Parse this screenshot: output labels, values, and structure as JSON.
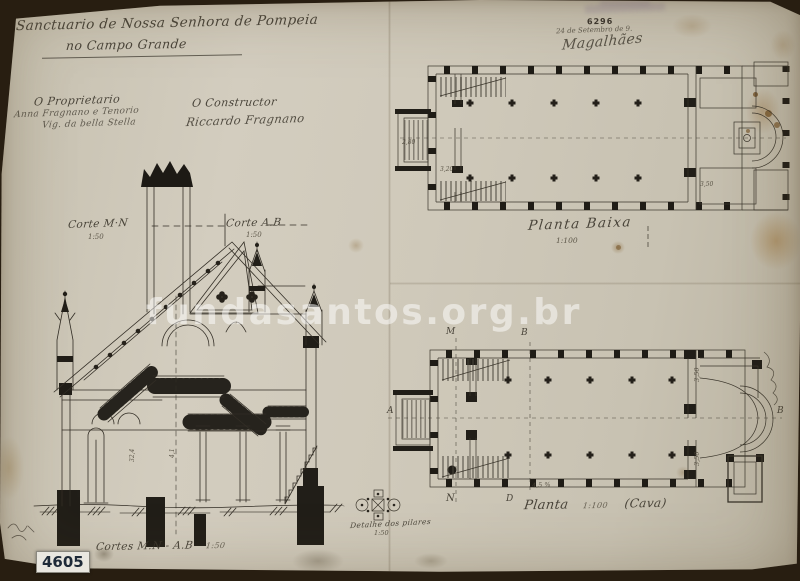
{
  "photo": {
    "archive_number": "4605",
    "watermark": "fundasantos.org.br"
  },
  "title": {
    "line1": "Sanctuario de Nossa Senhora de Pompeia",
    "line2": "no Campo Grande"
  },
  "stamp": {
    "number": "6296",
    "date": "24 de Setembro de 9.",
    "signature": "Magalhães"
  },
  "parties": {
    "proprietor_label": "O Proprietario",
    "proprietor_sig1": "Anna Fragnano e Tenorio",
    "proprietor_sig2": "Vig. da bella Stella",
    "constructor_label": "O Constructor",
    "constructor_sig": "Riccardo Fragnano"
  },
  "section": {
    "corte_left": "Corte M·N",
    "corte_left_scale": "1:50",
    "corte_right": "Corte A.B",
    "corte_right_scale": "1:50",
    "caption": "Cortes M.N - A.B",
    "caption_scale": "1:50",
    "dim_a": "32,4",
    "dim_b": "4,1"
  },
  "plan_upper": {
    "caption": "Planta Baixa",
    "scale": "1:100",
    "dim_a": "2,80",
    "dim_b": "3,20",
    "dim_c": "3,50"
  },
  "plan_lower": {
    "caption": "Planta",
    "scale": "1:100",
    "suffix": "(Cava)",
    "marker_m": "M",
    "marker_b_top": "B",
    "marker_a": "A",
    "marker_b_right": "B",
    "marker_n": "N",
    "marker_d": "D",
    "dim_a": "3,50",
    "dim_b": "3,50",
    "dim_c": "4,5 %"
  },
  "pillar_detail": {
    "caption": "Detalhe dos pilares",
    "scale": "1:50"
  },
  "colors": {
    "paper": "#cdc7b8",
    "ink": "#332e26",
    "backing": "#241b10",
    "watermark": "rgba(255,255,255,0.5)"
  }
}
